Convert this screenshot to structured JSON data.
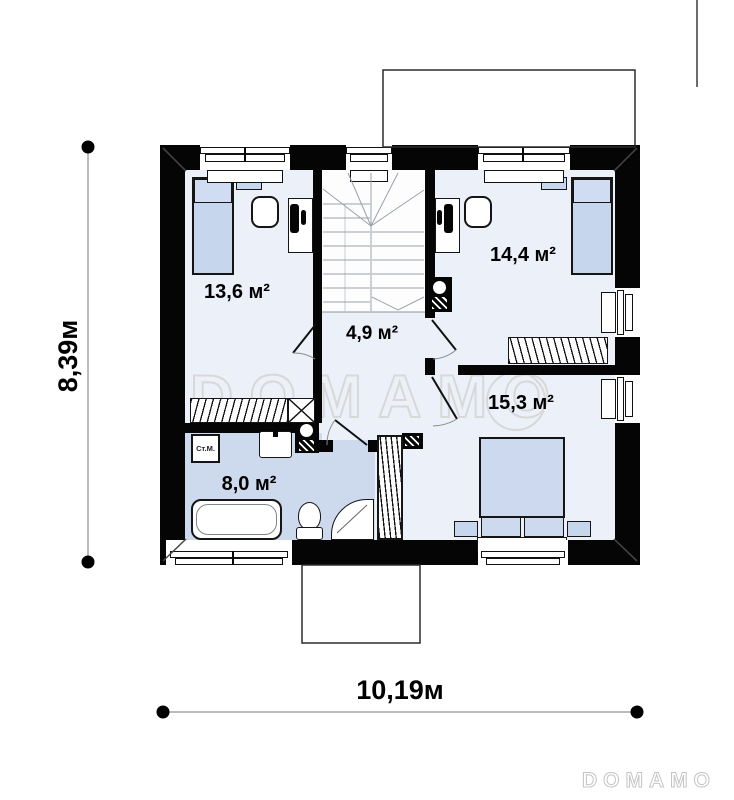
{
  "plan": {
    "watermark": "DOMAMO",
    "brand_logo": "DOMAMO",
    "rooms": [
      {
        "id": "bedroom-left",
        "area_label": "13,6 м²"
      },
      {
        "id": "bedroom-right",
        "area_label": "14,4 м²"
      },
      {
        "id": "hall",
        "area_label": "4,9 м²"
      },
      {
        "id": "bedroom-bottom",
        "area_label": "15,3 м²"
      },
      {
        "id": "bathroom",
        "area_label": "8,0 м²"
      }
    ],
    "labels": {
      "washing_machine": "Ст.М."
    },
    "dimensions": {
      "vertical": "8,39м",
      "horizontal": "10,19м"
    },
    "colors": {
      "wall": "#050505",
      "floor": "#ecf1f9",
      "bathroom_floor": "#cdd9ec",
      "furniture_fill": "#c6d6ed"
    }
  }
}
